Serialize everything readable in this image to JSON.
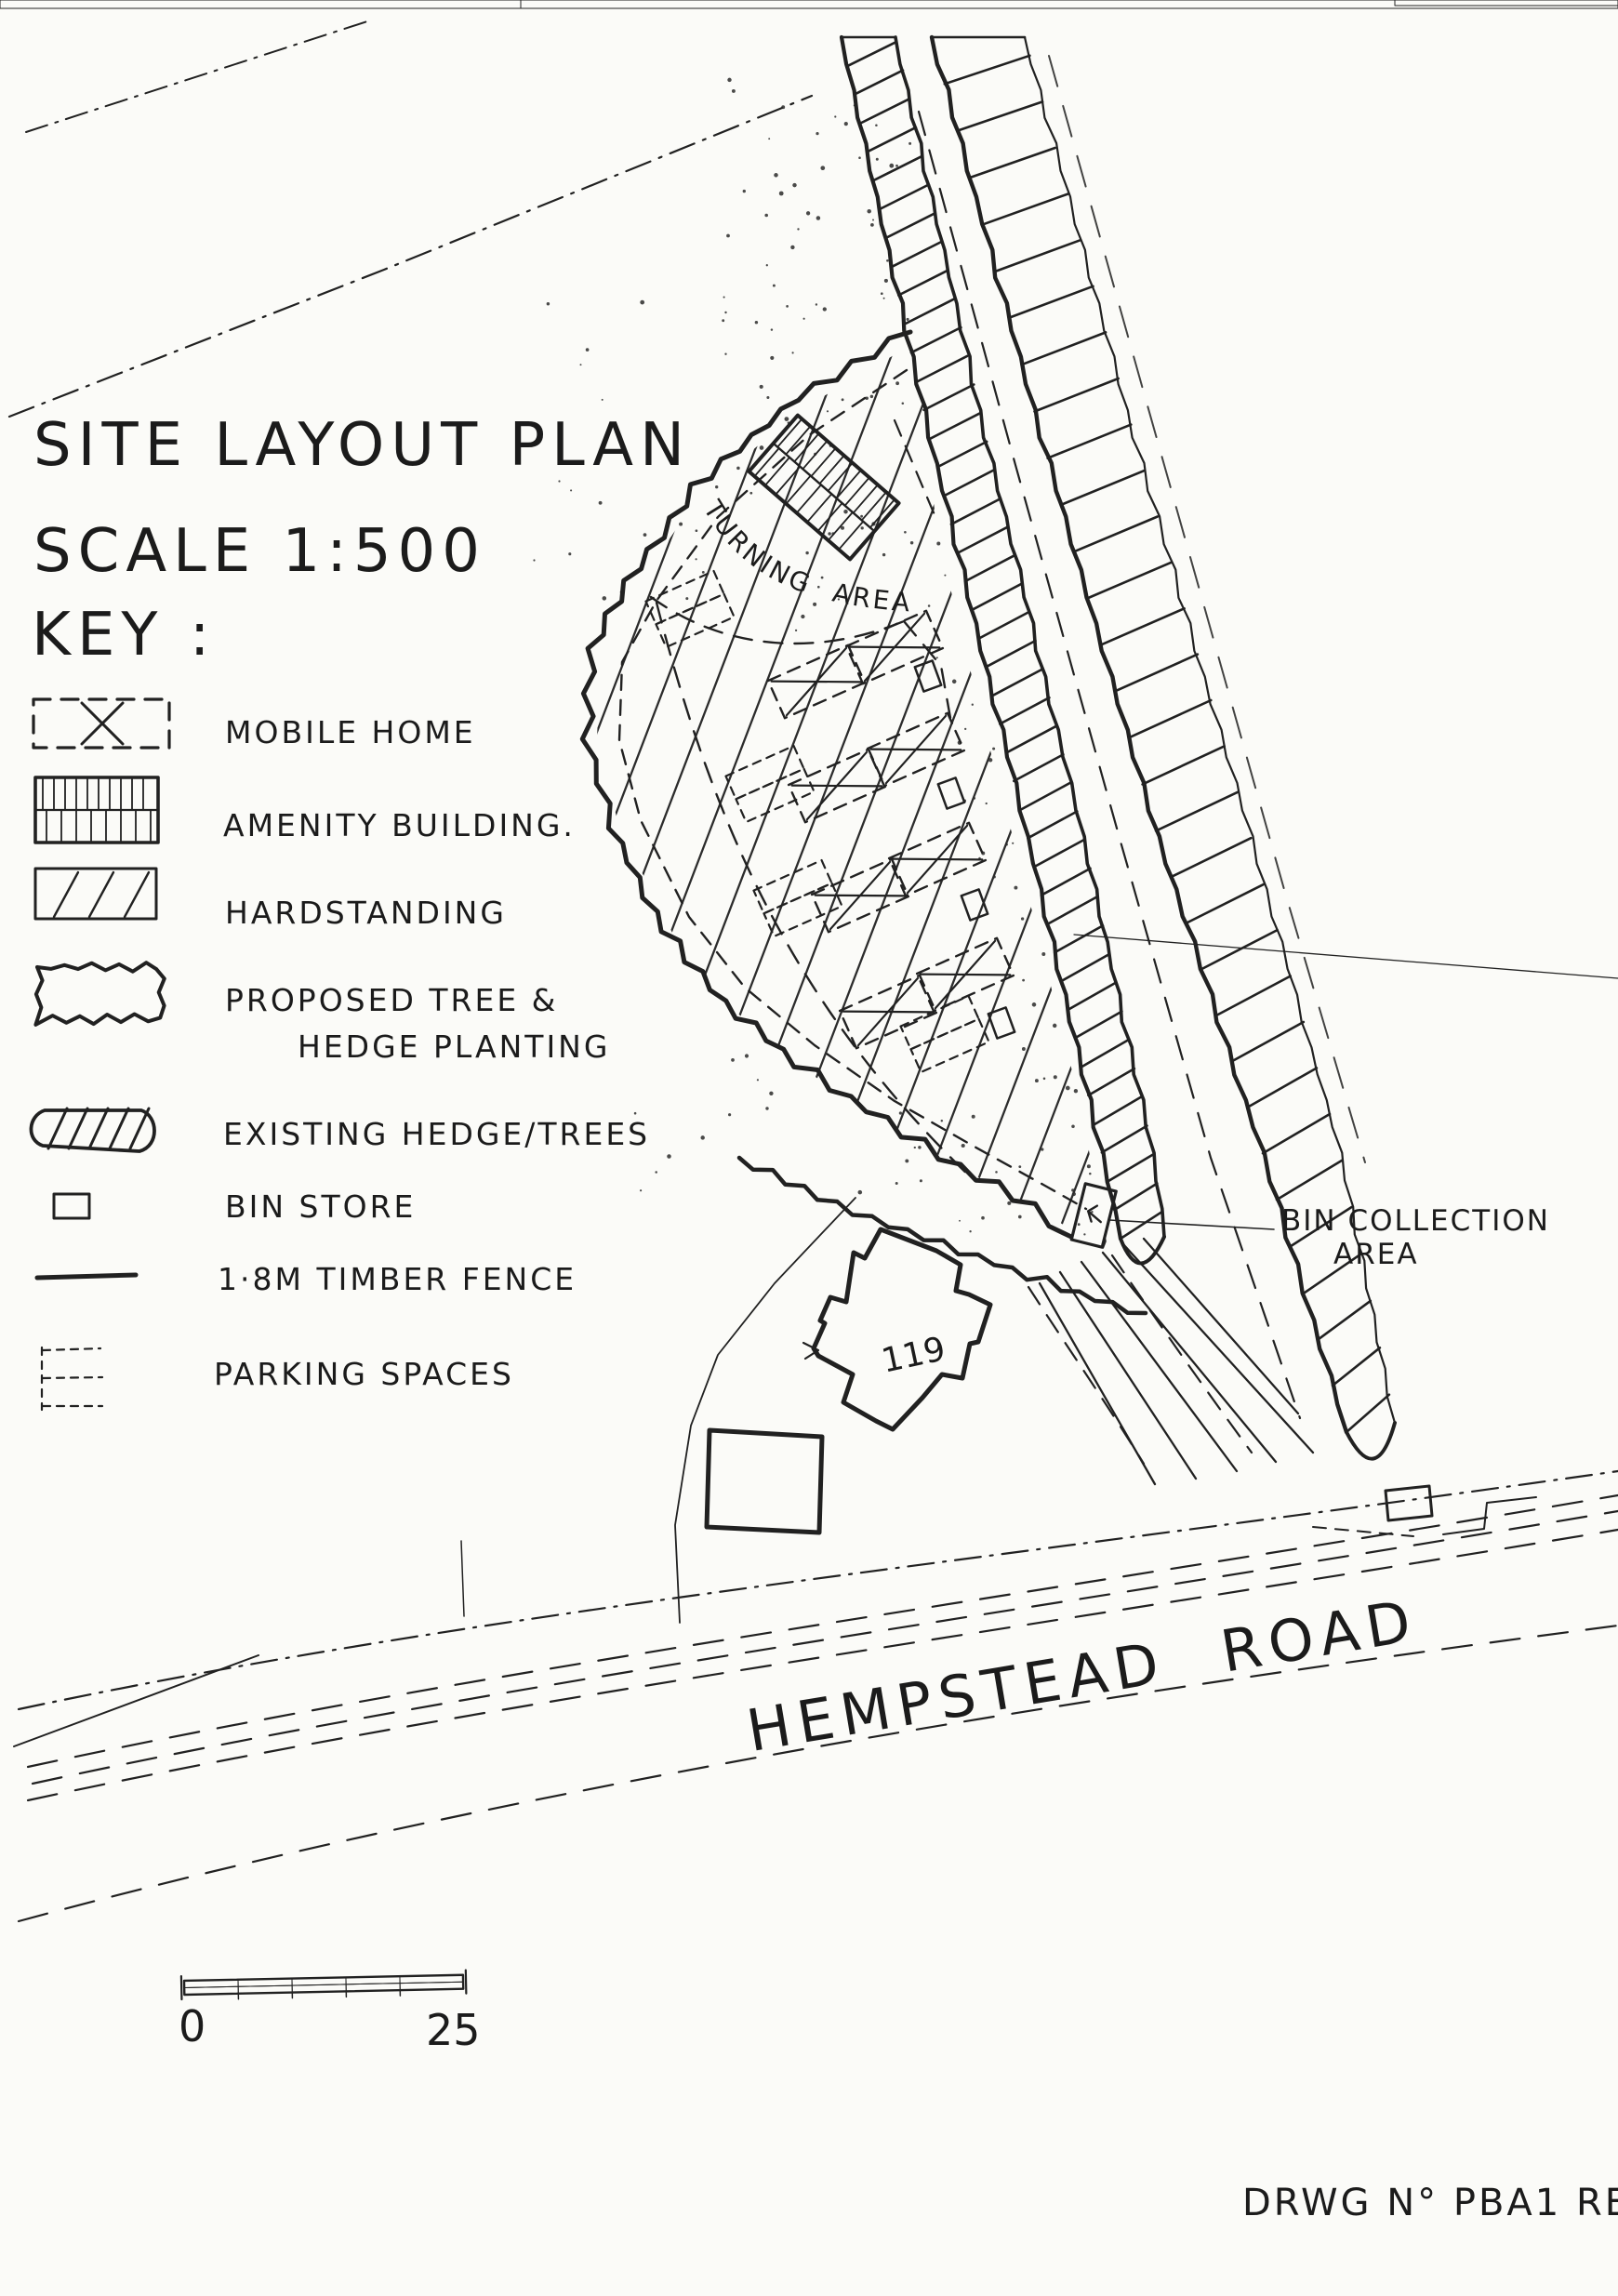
{
  "document": {
    "title": "SITE LAYOUT PLAN",
    "scale_label": "SCALE 1:500",
    "key_heading": "KEY :",
    "drawing_number": "DRWG N° PBA1 REV A"
  },
  "legend": {
    "items": [
      {
        "label": "MOBILE HOME"
      },
      {
        "label": "AMENITY BUILDING."
      },
      {
        "label": "HARDSTANDING"
      },
      {
        "label_line1": "PROPOSED TREE &",
        "label_line2": "HEDGE PLANTING"
      },
      {
        "label": "EXISTING HEDGE/TREES"
      },
      {
        "label": "BIN STORE"
      },
      {
        "label": "1·8M TIMBER FENCE"
      },
      {
        "label": "PARKING SPACES"
      }
    ]
  },
  "plan": {
    "turning_area_label": "TURNING AREA",
    "bin_collection_label_line1": "BIN COLLECTION",
    "bin_collection_label_line2": "AREA",
    "house_number": "119",
    "road_name": "HEMPSTEAD ROAD",
    "scale_bar_start": "0",
    "scale_bar_end": "25"
  },
  "colors": {
    "ink": "#212121",
    "hardstanding_blue": "#a7cdd3",
    "bin_green": "#3aa330",
    "paper": "#fbfbf8"
  }
}
